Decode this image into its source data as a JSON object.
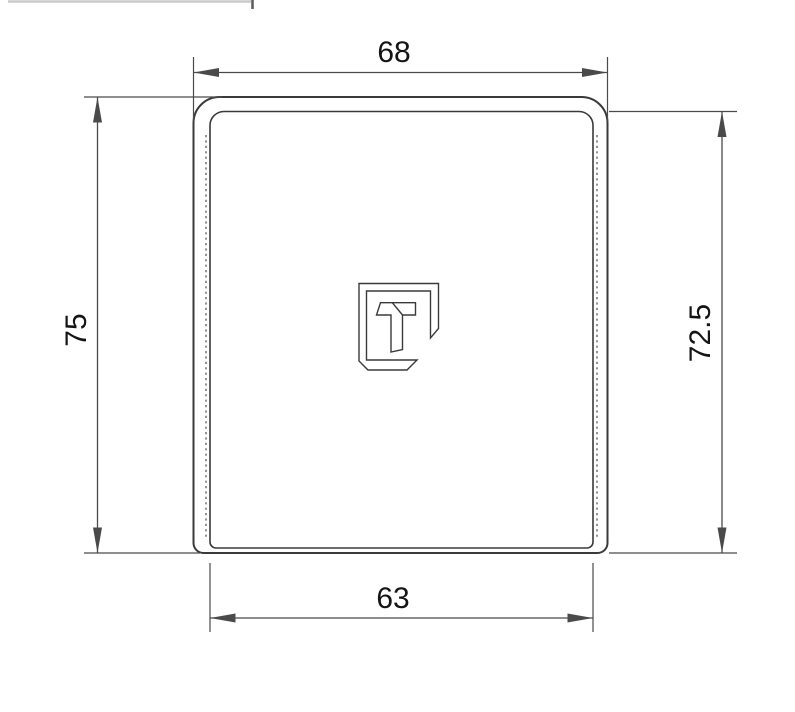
{
  "drawing": {
    "dimensions": {
      "top_width": "68",
      "bottom_width": "63",
      "left_height": "75",
      "right_height": "72.5"
    },
    "colors": {
      "background": "#ffffff",
      "outline": "#3a3a3a",
      "dimension-line": "#4a4a4a",
      "hidden-line": "#5a5a5a",
      "dim-text": "#141414",
      "artifact-line": "#c9c9c9",
      "artifact-tick": "#606060"
    },
    "logo": {
      "name": "t-emblem"
    }
  }
}
